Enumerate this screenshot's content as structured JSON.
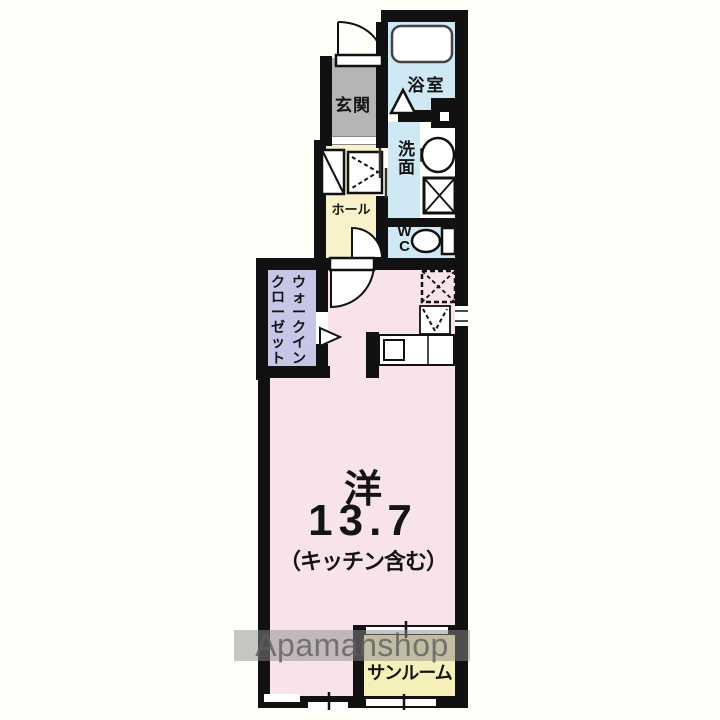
{
  "watermark": "Apamanshop",
  "rooms": {
    "genkan": {
      "label": "玄関"
    },
    "bathroom": {
      "label": "浴室"
    },
    "washroom": {
      "label": "洗面"
    },
    "hall": {
      "label": "ホール"
    },
    "wc": {
      "line1": "W",
      "line2": "C"
    },
    "walk_in_closet": {
      "column_right": "ウォークイン",
      "column_left": "クローゼット"
    },
    "main_room": {
      "type_label": "洋",
      "size_jo": "13.7",
      "note": "（キッチン含む）"
    },
    "sunroom": {
      "label": "サンルーム"
    }
  },
  "symbols": [
    "bathtub-icon",
    "bath-door-triangle-icon",
    "entrance-door-arc",
    "shoe-cabinet-icon",
    "hall-storage-icon",
    "sliding-door-icon",
    "washbasin-icon",
    "washing-machine-icon",
    "toilet-icon",
    "wc-door-arc",
    "room-door-arc",
    "closet-door-triangle-icon",
    "refrigerator-icon",
    "stove-icon",
    "kitchen-sink-icon",
    "window-icon"
  ],
  "colors": {
    "wall": "#111111",
    "bg": "#fffef8",
    "room_pink": "#f8e2ec",
    "hall_yellow": "#f9f1c9",
    "sunroom_yellow": "#f5efba",
    "water_blue": "#cfe8f3",
    "closet_lavender": "#c6c6e6",
    "genkan_gray": "#b5b5b5",
    "watermark_band": "rgba(140,140,140,0.5)",
    "watermark_text": "#5f5f5f"
  }
}
